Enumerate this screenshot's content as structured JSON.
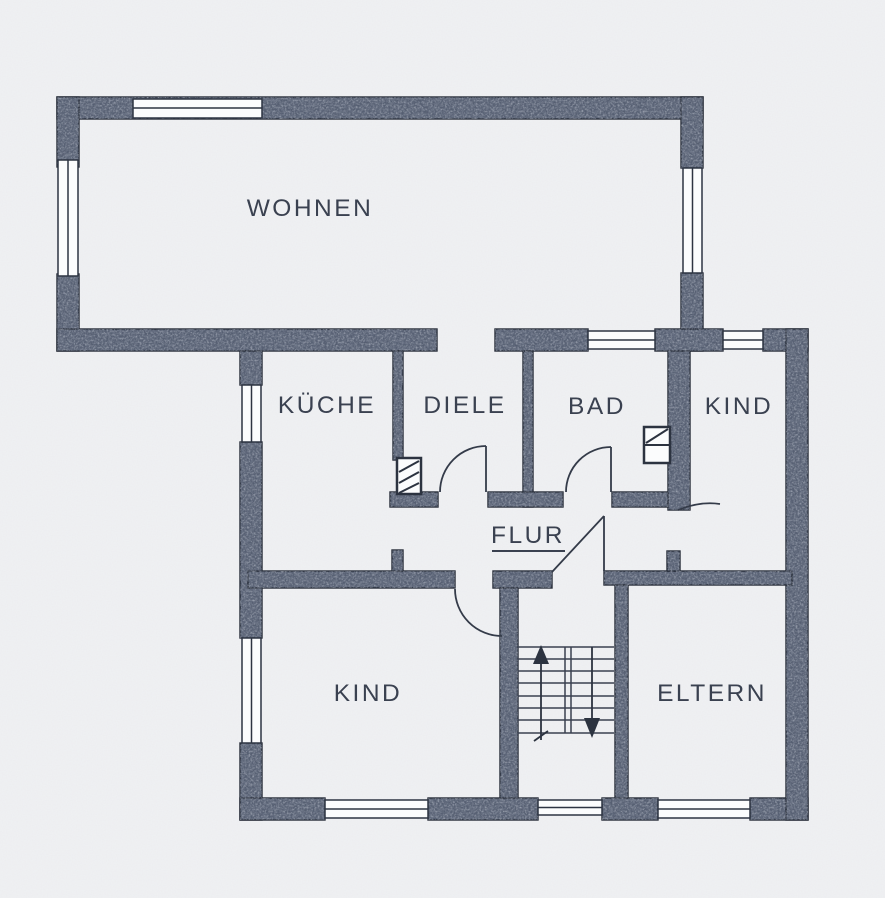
{
  "plan_title": "Grundriss Obergeschoss",
  "rooms": [
    {
      "key": "wohnen",
      "label": "WOHNEN"
    },
    {
      "key": "kueche",
      "label": "KÜCHE"
    },
    {
      "key": "diele",
      "label": "DIELE"
    },
    {
      "key": "bad",
      "label": "BAD"
    },
    {
      "key": "kind-og",
      "label": "KIND"
    },
    {
      "key": "flur",
      "label": "FLUR"
    },
    {
      "key": "kind-ug",
      "label": "KIND"
    },
    {
      "key": "eltern",
      "label": "ELTERN"
    }
  ],
  "icons": {
    "stairs_up_arrow": "arrow-up",
    "stairs_down_arrow": "arrow-down",
    "shaft_symbol": "hatched-duct-box",
    "door_symbol": "quarter-circle-swing",
    "window_symbol": "double-line-pane"
  },
  "colors": {
    "paper": "#f0f1f3",
    "wall_fill": "#565f72",
    "wall_fleck_dark": "#343b4c",
    "wall_fleck_light": "#99a0b0",
    "ink_line": "#2c3340",
    "window_white": "#fbfcfd",
    "label_text": "#3a4150"
  }
}
